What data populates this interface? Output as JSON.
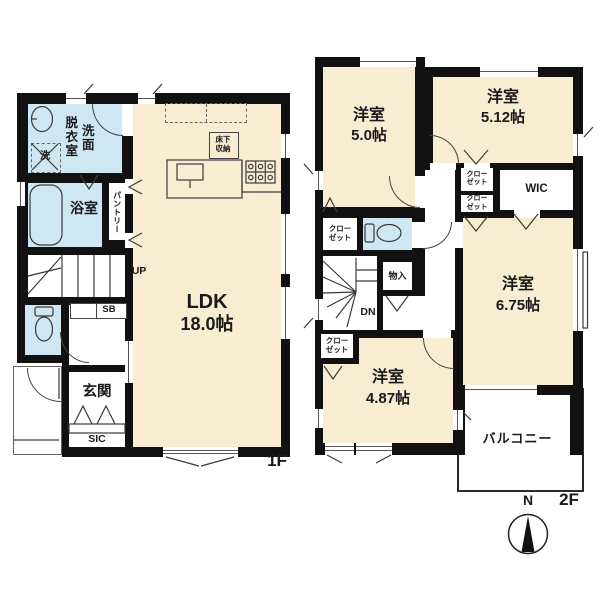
{
  "colors": {
    "wall": "#111111",
    "room_cream": "#f8ecd2",
    "room_blue": "#cfe7f3",
    "line": "#3a3a3a"
  },
  "floor1": {
    "floor_label": "1F",
    "ldk": {
      "name": "LDK",
      "size": "18.0帖"
    },
    "washroom": {
      "line_right": "洗面",
      "line_left": "脱衣室"
    },
    "bathroom": {
      "name": "浴室"
    },
    "laundry_mark": "洗",
    "pantry": {
      "name": "パントリー"
    },
    "stairs_label": "UP",
    "shoe_box": "SB",
    "entrance": {
      "name": "玄関"
    },
    "shoe_closet": "SIC",
    "floor_storage": {
      "line1": "床下",
      "line2": "収納"
    }
  },
  "floor2": {
    "floor_label": "2F",
    "bedroom_a": {
      "name": "洋室",
      "size": "5.0帖"
    },
    "bedroom_b": {
      "name": "洋室",
      "size": "5.12帖"
    },
    "bedroom_c": {
      "name": "洋室",
      "size": "6.75帖"
    },
    "bedroom_d": {
      "name": "洋室",
      "size": "4.87帖"
    },
    "wic": "WIC",
    "closet": {
      "line1": "クロー",
      "line2": "ゼット"
    },
    "storage": {
      "name": "物入"
    },
    "stairs_label": "DN",
    "balcony": {
      "name": "バルコニー"
    }
  },
  "compass": {
    "north": "N"
  }
}
